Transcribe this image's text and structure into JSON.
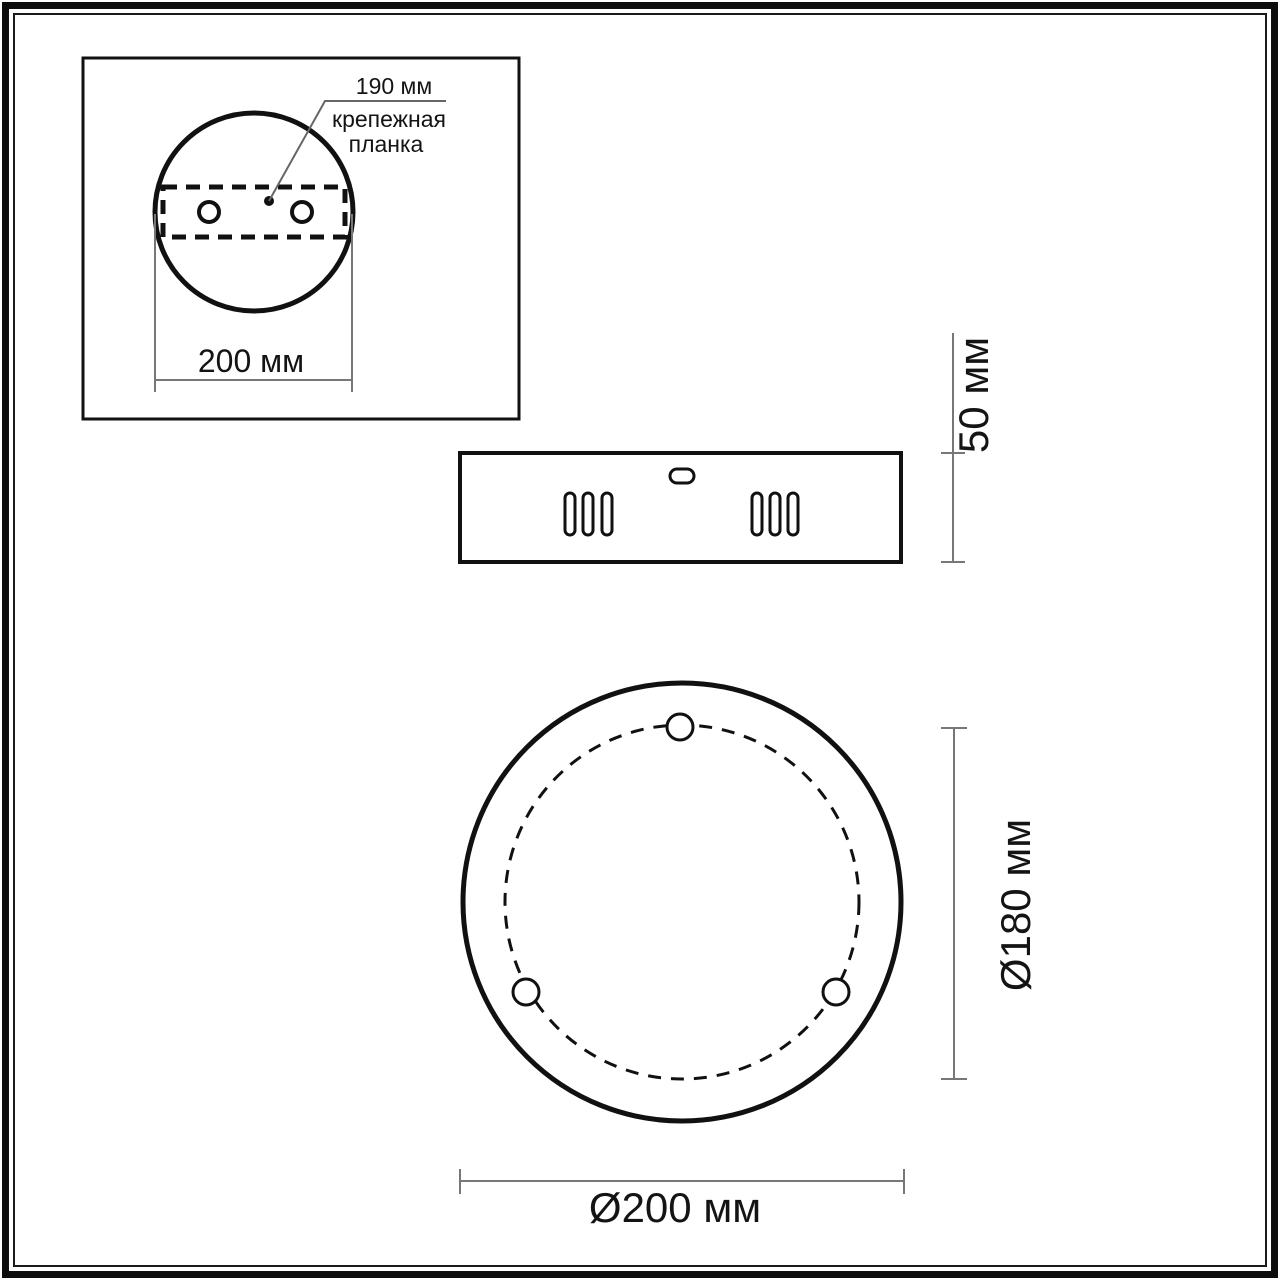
{
  "drawing": {
    "inset_detail": {
      "callout_value": "190 мм",
      "callout_label_line1": "крепежная",
      "callout_label_line2": "планка",
      "width_dimension": "200 мм"
    },
    "side_view": {
      "height_dimension": "50 мм"
    },
    "front_view": {
      "inner_diameter_dimension": "Ø180 мм",
      "outer_diameter_dimension": "Ø200 мм"
    },
    "colors": {
      "ink": "#111111",
      "dimension_line": "#777777"
    }
  }
}
